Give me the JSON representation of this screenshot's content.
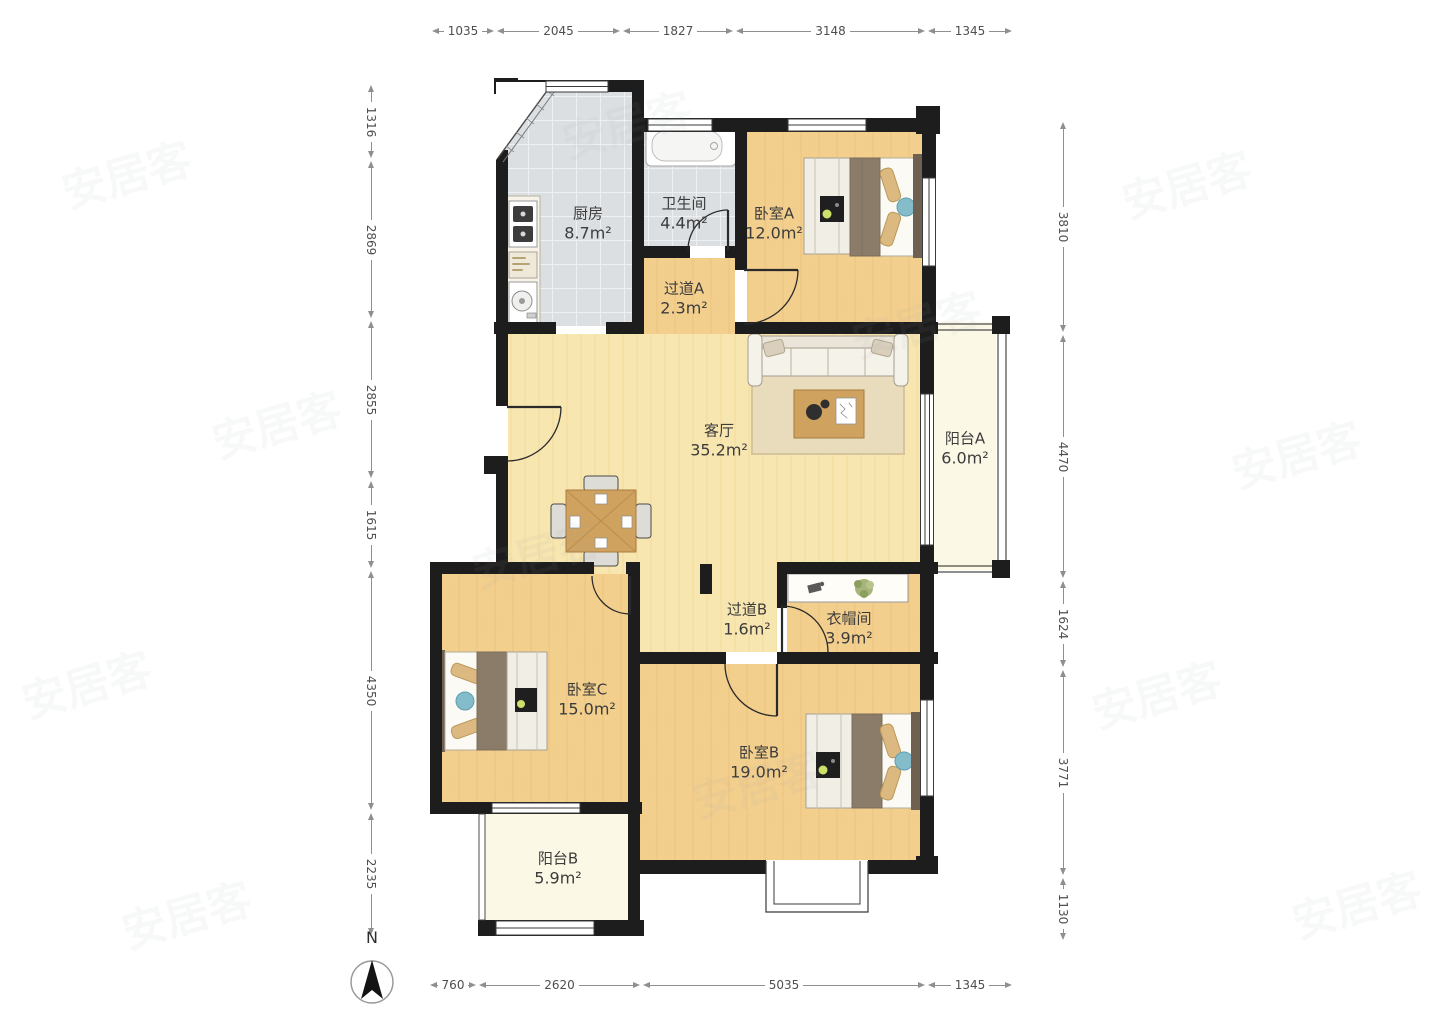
{
  "watermark": "安居客",
  "compass": {
    "label": "N"
  },
  "rooms": [
    {
      "name": "厨房",
      "area": "8.7m²"
    },
    {
      "name": "卫生间",
      "area": "4.4m²"
    },
    {
      "name": "过道A",
      "area": "2.3m²"
    },
    {
      "name": "卧室A",
      "area": "12.0m²"
    },
    {
      "name": "客厅",
      "area": "35.2m²"
    },
    {
      "name": "阳台A",
      "area": "6.0m²"
    },
    {
      "name": "过道B",
      "area": "1.6m²"
    },
    {
      "name": "衣帽间",
      "area": "3.9m²"
    },
    {
      "name": "卧室C",
      "area": "15.0m²"
    },
    {
      "name": "卧室B",
      "area": "19.0m²"
    },
    {
      "name": "阳台B",
      "area": "5.9m²"
    }
  ],
  "dims": {
    "top": [
      "1035",
      "2045",
      "1827",
      "3148",
      "1345"
    ],
    "bottom": [
      "760",
      "2620",
      "5035",
      "1345"
    ],
    "left": [
      "1316",
      "2869",
      "2855",
      "1615",
      "4350",
      "2235"
    ],
    "right": [
      "3810",
      "4470",
      "1624",
      "3771",
      "1130"
    ]
  },
  "colors": {
    "wall": "#1d1d1d",
    "wood": "#f3cf8e",
    "living": "#f8e6b0",
    "tile": "#dbdfe1",
    "balcony": "#fcf8e6"
  }
}
